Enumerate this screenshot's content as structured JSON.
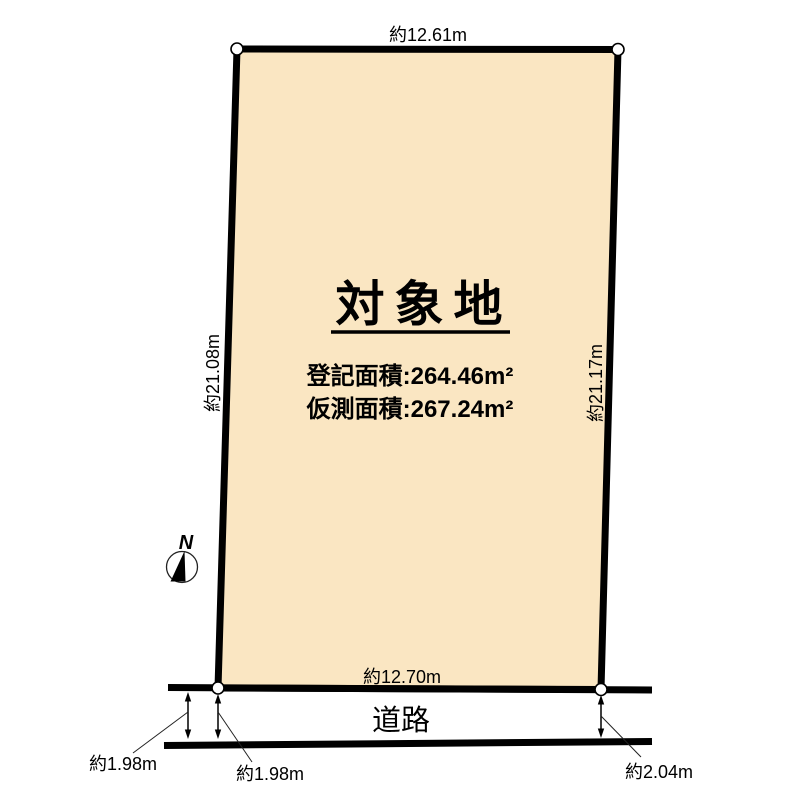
{
  "plot": {
    "title": "対象地",
    "registered_area": "登記面積:264.46m²",
    "surveyed_area": "仮測面積:267.24m²",
    "fill_color": "#FAE6C2"
  },
  "dimensions": {
    "top": "約12.61m",
    "left": "約21.08m",
    "right": "約21.17m",
    "bottom": "約12.70m"
  },
  "road": {
    "label": "道路"
  },
  "setbacks": {
    "left_outer": "約1.98m",
    "left_inner": "約1.98m",
    "right": "約2.04m"
  },
  "compass": {
    "north_label": "N"
  },
  "colors": {
    "line": "#000000",
    "background": "#FFFFFF"
  }
}
